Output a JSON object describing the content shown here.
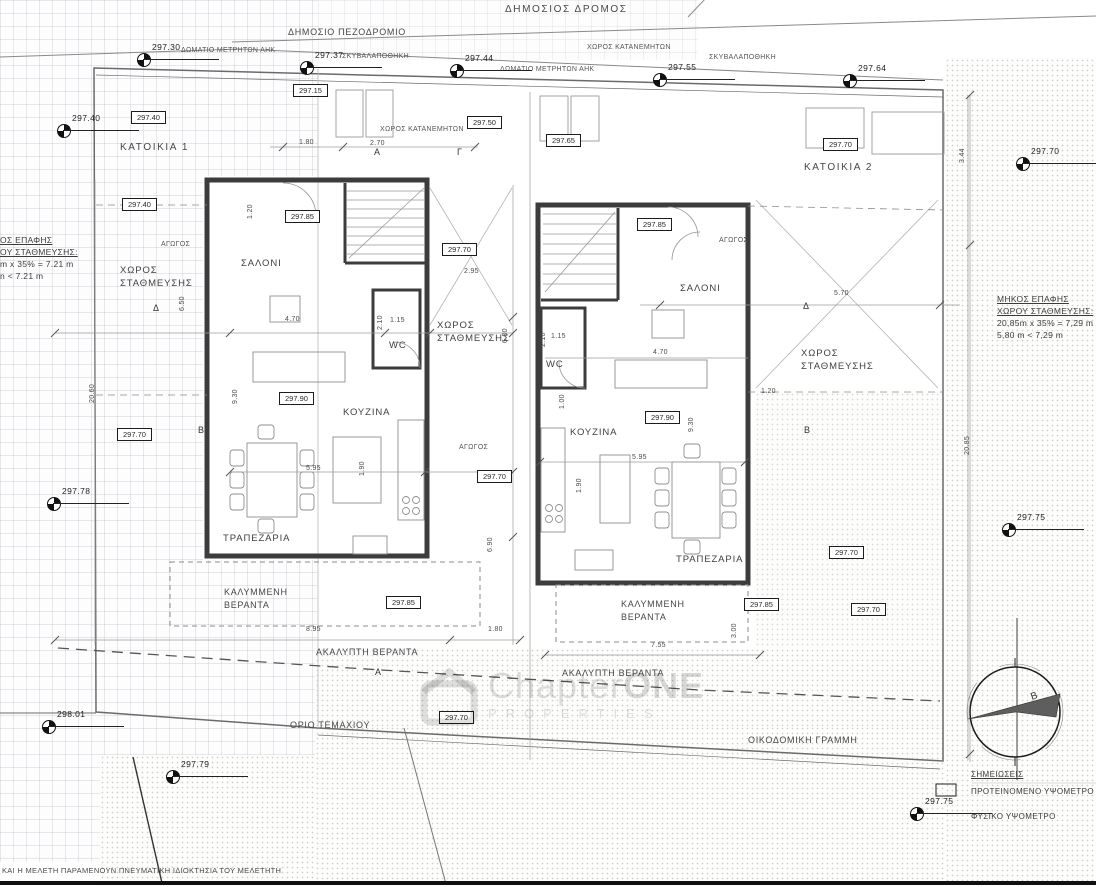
{
  "plan": {
    "road": "ΔΗΜΟΣΙΟΣ ΔΡΟΜΟΣ",
    "sidewalk": "ΔΗΜΟΣΙΟ ΠΕΖΟΔΡΟΜΙΟ",
    "plot_boundary": "ΟΡΙΟ ΤΕΜΑΧΙΟΥ",
    "building_line": "ΟΙΚΟΔΟΜΙΚΗ ΓΡΑΜΜΗ",
    "copyright": "ΚΑΙ Η ΜΕΛΕΤΗ ΠΑΡΑΜΕΝΟΥΝ ΠΝΕΥΜΑΤΙΚΗ ΙΔΙΟΚΤΗΣΙΑ ΤΟΥ ΜΕΛΕΤΗΤΗ"
  },
  "site_labels": {
    "meter_room_a": "ΔΩΜΑΤΙΟ ΜΕΤΡΗΤΩΝ ΑΗΚ",
    "garbage_a": "ΣΚΥΒΑΛΑΠΟΘΗΚΗ",
    "meter_room_b": "ΔΩΜΑΤΙΟ ΜΕΤΡΗΤΩΝ ΑΗΚ",
    "garbage_b": "ΣΚΥΒΑΛΑΠΟΘΗΚΗ",
    "distributor_a": "ΧΩΡΟΣ ΚΑΤΑΝΕΜΗΤΩΝ",
    "distributor_b": "ΧΩΡΟΣ ΚΑΤΑΝΕΜΗΤΩΝ",
    "duct_1": "ΑΓΩΓΟΣ",
    "duct_2": "ΑΓΩΓΟΣ",
    "duct_3": "ΑΓΩΓΟΣ"
  },
  "house1": {
    "name": "ΚΑΤΟΙΚΙΑ 1",
    "living_room": "ΣΑΛΟΝΙ",
    "kitchen": "ΚΟΥΖΙΝΑ",
    "dining_room": "ΤΡΑΠΕΖΑΡΙΑ",
    "wc": "WC",
    "parking_left_l1": "ΧΩΡΟΣ",
    "parking_left_l2": "ΣΤΑΘΜΕΥΣΗΣ",
    "parking_right_l1": "ΧΩΡΟΣ",
    "parking_right_l2": "ΣΤΑΘΜΕΥΣΗΣ",
    "covered_veranda_l1": "ΚΑΛΥΜΜΕΝΗ",
    "covered_veranda_l2": "ΒΕΡΑΝΤΑ",
    "open_veranda": "ΑΚΑΛΥΠΤΗ ΒΕΡΑΝΤΑ"
  },
  "house2": {
    "name": "ΚΑΤΟΙΚΙΑ 2",
    "living_room": "ΣΑΛΟΝΙ",
    "kitchen": "ΚΟΥΖΙΝΑ",
    "dining_room": "ΤΡΑΠΕΖΑΡΙΑ",
    "wc": "WC",
    "parking_l1": "ΧΩΡΟΣ",
    "parking_l2": "ΣΤΑΘΜΕΥΣΗΣ",
    "covered_veranda_l1": "ΚΑΛΥΜΜΕΝΗ",
    "covered_veranda_l2": "ΒΕΡΑΝΤΑ",
    "open_veranda": "ΑΚΑΛΥΠΤΗ ΒΕΡΑΝΤΑ"
  },
  "parking_note_right": {
    "l1": "ΜΗΚΟΣ ΕΠΑΦΗΣ",
    "l2": "ΧΩΡΟΥ ΣΤΑΘΜΕΥΣΗΣ:",
    "l3": "20,85m x 35% = 7,29 m",
    "l4": "5,80 m < 7,29 m"
  },
  "parking_note_left": {
    "l1": "ΟΣ ΕΠΑΦΗΣ",
    "l2": "ΟΥ ΣΤΑΘΜΕΥΣΗΣ:",
    "l3": "m x 35% = 7.21 m",
    "l4": "n < 7.21 m"
  },
  "notes": {
    "heading": "ΣΗΜΕΙΩΣΕΙΣ",
    "proposed": "ΠΡΟΤΕΙΝΟΜΕΝΟ ΥΨΟΜΕΤΡΟ",
    "natural": "ΦΥΣΙΚΟ ΥΨΟΜΕΤΡΟ"
  },
  "watermark": {
    "brand_regular": "Chapter",
    "brand_bold": "ONE",
    "subtitle": "PROPERTIES"
  },
  "compass": {
    "north_letter": "Β"
  },
  "spot_elevations": [
    "297.30",
    "297.37",
    "297.44",
    "297.55",
    "297.64",
    "297.40",
    "297.70",
    "297.78",
    "297.75",
    "298.01",
    "297.79",
    "297.75"
  ],
  "boxed_elevations": [
    "297.15",
    "297.40",
    "297.40",
    "297.85",
    "297.70",
    "297.50",
    "297.65",
    "297.70",
    "297.85",
    "297.70",
    "297.90",
    "297.70",
    "297.90",
    "297.70",
    "297.85",
    "297.85",
    "297.70",
    "297.70"
  ],
  "dimensions": [
    "1.80",
    "2.70",
    "2.95",
    "4.70",
    "1.15",
    "2.10",
    "6.00",
    "1.20",
    "6.50",
    "9.30",
    "5.95",
    "1.90",
    "6.90",
    "8.95",
    "1.80",
    "20.60",
    "5.70",
    "4.70",
    "1.15",
    "2.10",
    "1.20",
    "1.00",
    "9.30",
    "5.95",
    "1.90",
    "3.00",
    "7.55",
    "3.44",
    "20.85"
  ],
  "section_markers": [
    "Δ",
    "Δ",
    "A",
    "Γ",
    "A",
    "B",
    "B"
  ],
  "colors": {
    "ink": "#1c1c1c",
    "wall": "#3c3c3c",
    "lightline": "#9a9a9a",
    "watermark": "#dedede"
  }
}
